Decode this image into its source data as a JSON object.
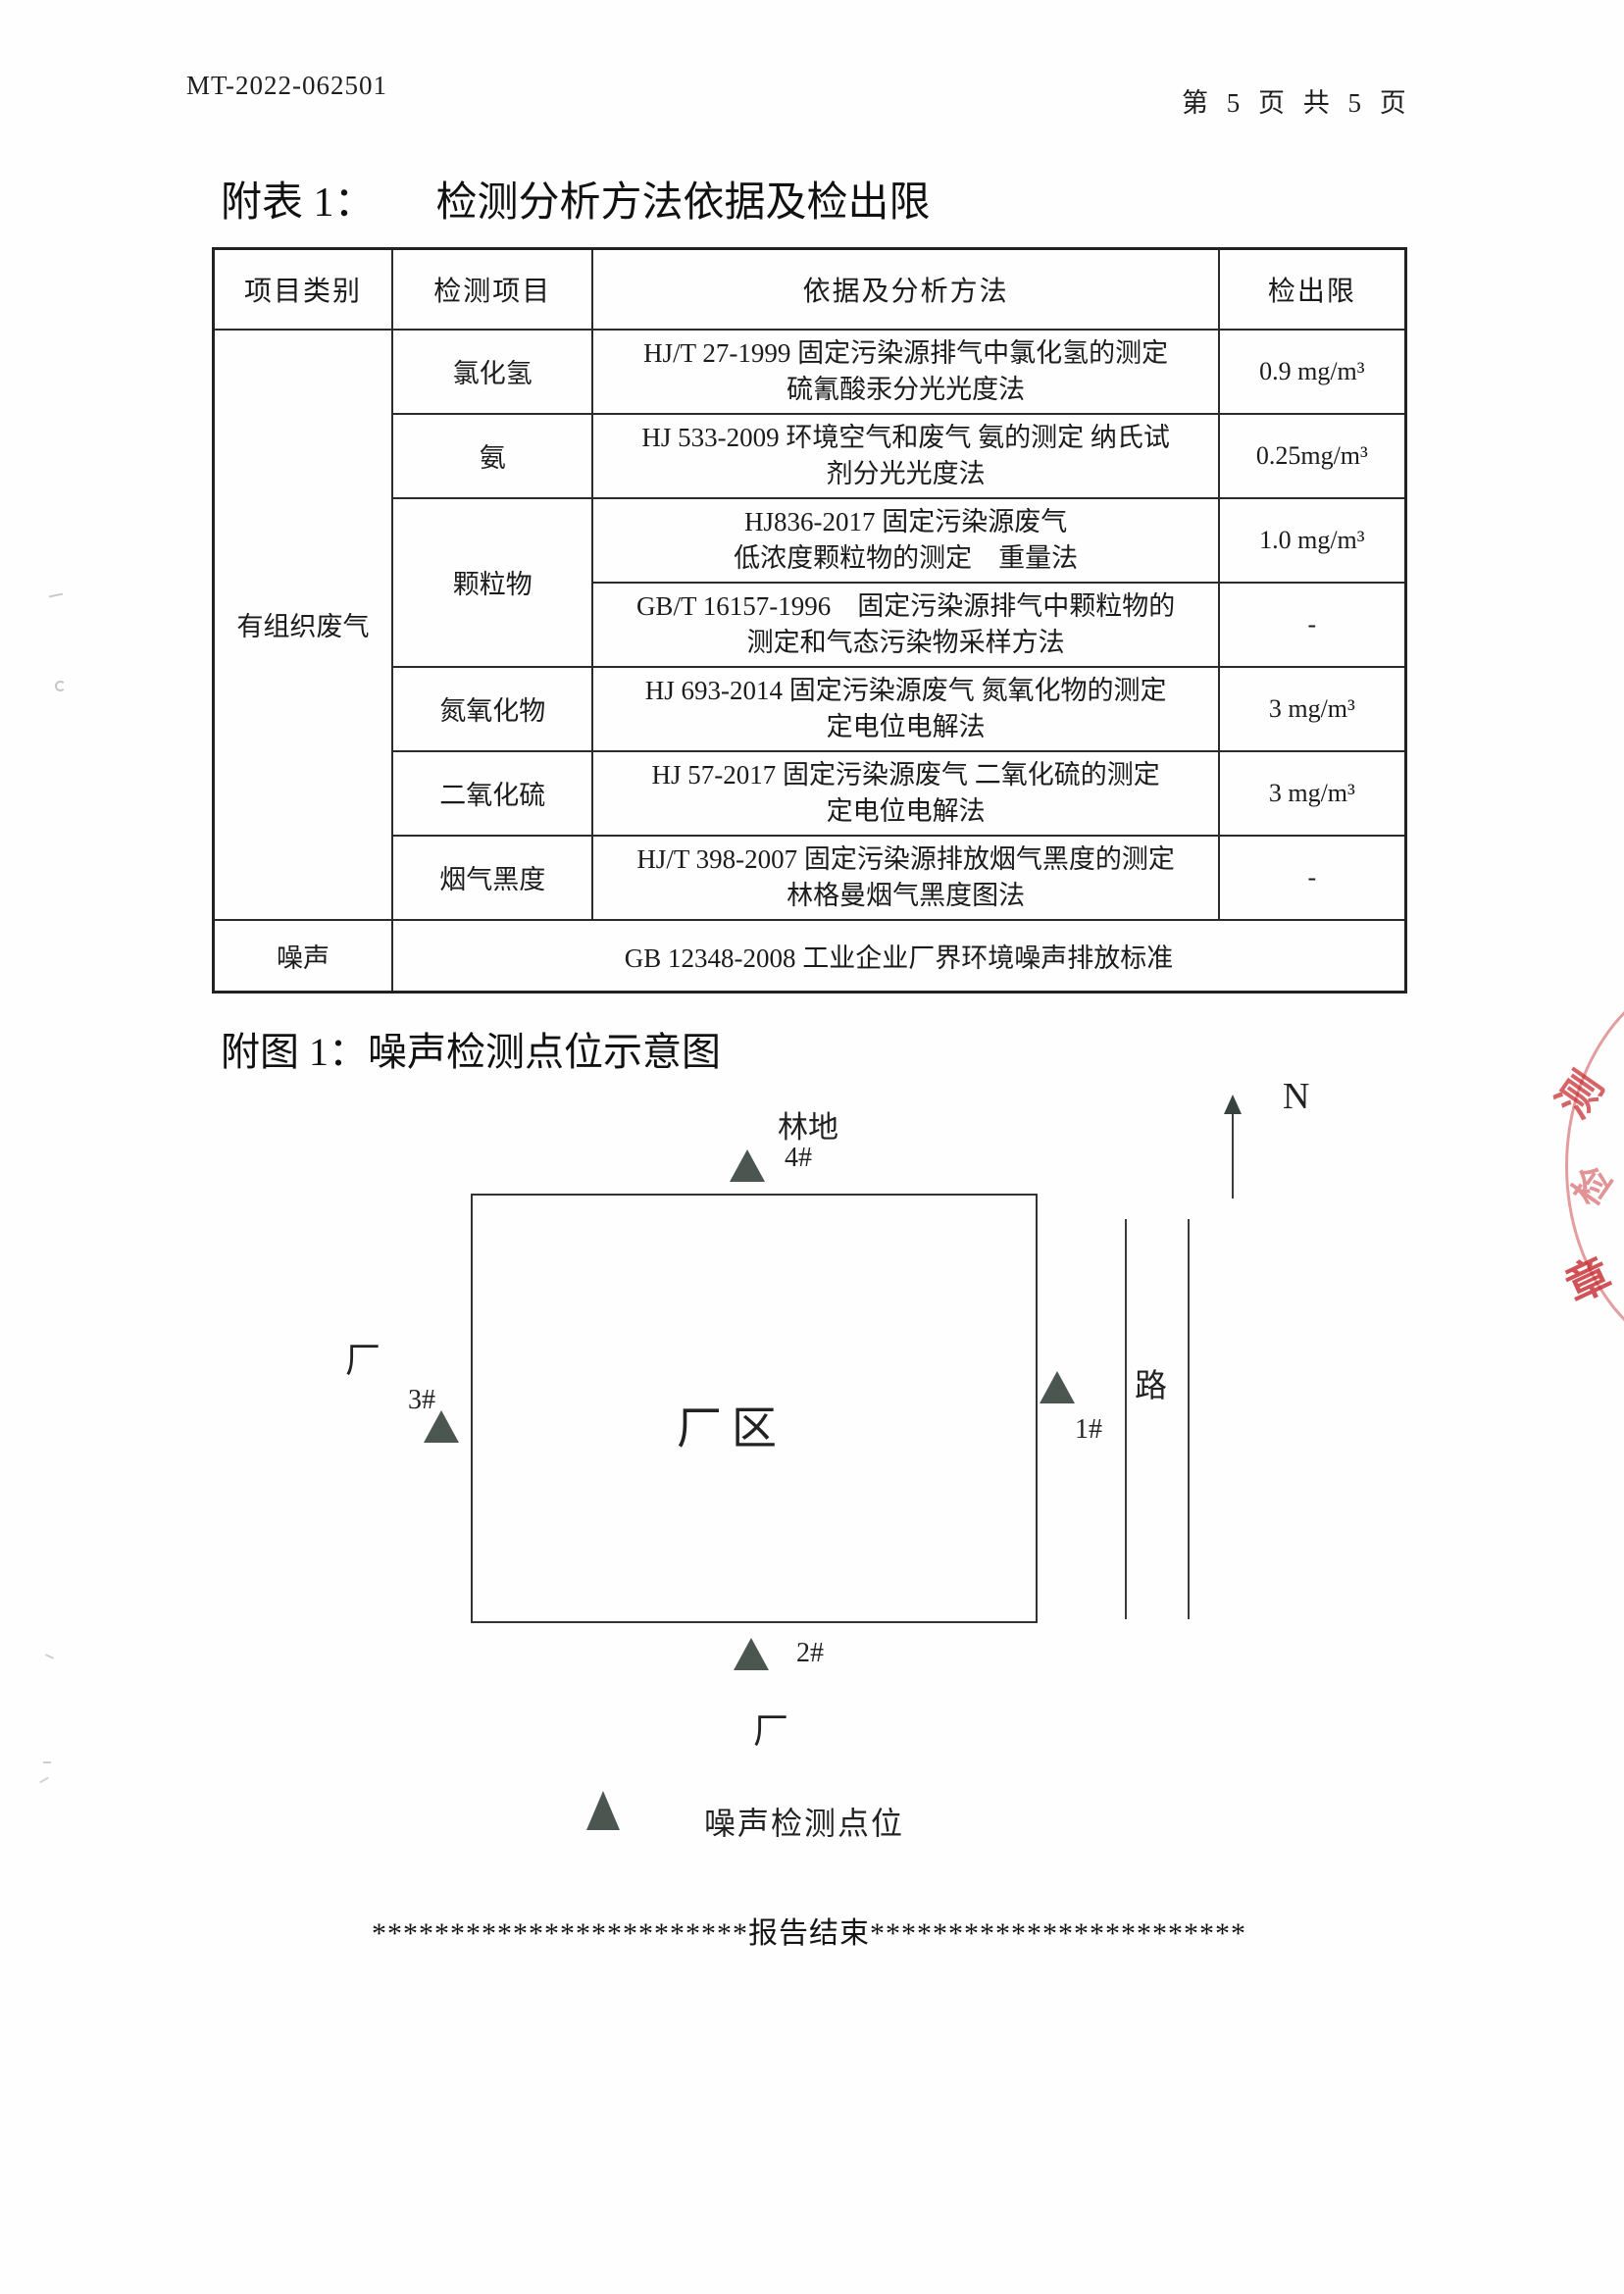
{
  "page": {
    "doc_number": "MT-2022-062501",
    "page_indicator": "第 5 页 共 5 页"
  },
  "table_section": {
    "title_prefix": "附表 1：",
    "title_text": "检测分析方法依据及检出限",
    "headers": [
      "项目类别",
      "检测项目",
      "依据及分析方法",
      "检出限"
    ],
    "category_label": "有组织废气",
    "rows": [
      {
        "item": "氯化氢",
        "method": [
          "HJ/T 27-1999 固定污染源排气中氯化氢的测定",
          "硫氰酸汞分光光度法"
        ],
        "limit": "0.9 mg/m³"
      },
      {
        "item": "氨",
        "method": [
          "HJ 533-2009 环境空气和废气 氨的测定 纳氏试",
          "剂分光光度法"
        ],
        "limit": "0.25mg/m³"
      },
      {
        "item": "颗粒物",
        "method": [
          "HJ836-2017 固定污染源废气",
          "低浓度颗粒物的测定　重量法"
        ],
        "limit": "1.0 mg/m³"
      },
      {
        "item": "",
        "method": [
          "GB/T 16157-1996　固定污染源排气中颗粒物的",
          "测定和气态污染物采样方法"
        ],
        "limit": "-"
      },
      {
        "item": "氮氧化物",
        "method": [
          "HJ 693-2014 固定污染源废气 氮氧化物的测定",
          "定电位电解法"
        ],
        "limit": "3 mg/m³"
      },
      {
        "item": "二氧化硫",
        "method": [
          "HJ 57-2017 固定污染源废气 二氧化硫的测定",
          "定电位电解法"
        ],
        "limit": "3 mg/m³"
      },
      {
        "item": "烟气黑度",
        "method": [
          "HJ/T 398-2007 固定污染源排放烟气黑度的测定",
          "林格曼烟气黑度图法"
        ],
        "limit": "-"
      }
    ],
    "noise_row": {
      "category": "噪声",
      "standard": "GB 12348-2008  工业企业厂界环境噪声排放标准"
    }
  },
  "figure_section": {
    "title": "附图 1：噪声检测点位示意图",
    "north_label": "N",
    "forest_label": "林地",
    "factory_area_label": "厂区",
    "road_label": "路",
    "neighbor_factory_left_label": "厂",
    "neighbor_factory_bottom_label": "厂",
    "point_labels": {
      "p1": "1#",
      "p2": "2#",
      "p3": "3#",
      "p4": "4#"
    },
    "legend_label": "噪声检测点位",
    "end_marker": "************************报告结束************************"
  },
  "stamp": {
    "color": "#c6282d",
    "partial_chars": [
      "测",
      "检",
      "章"
    ]
  }
}
